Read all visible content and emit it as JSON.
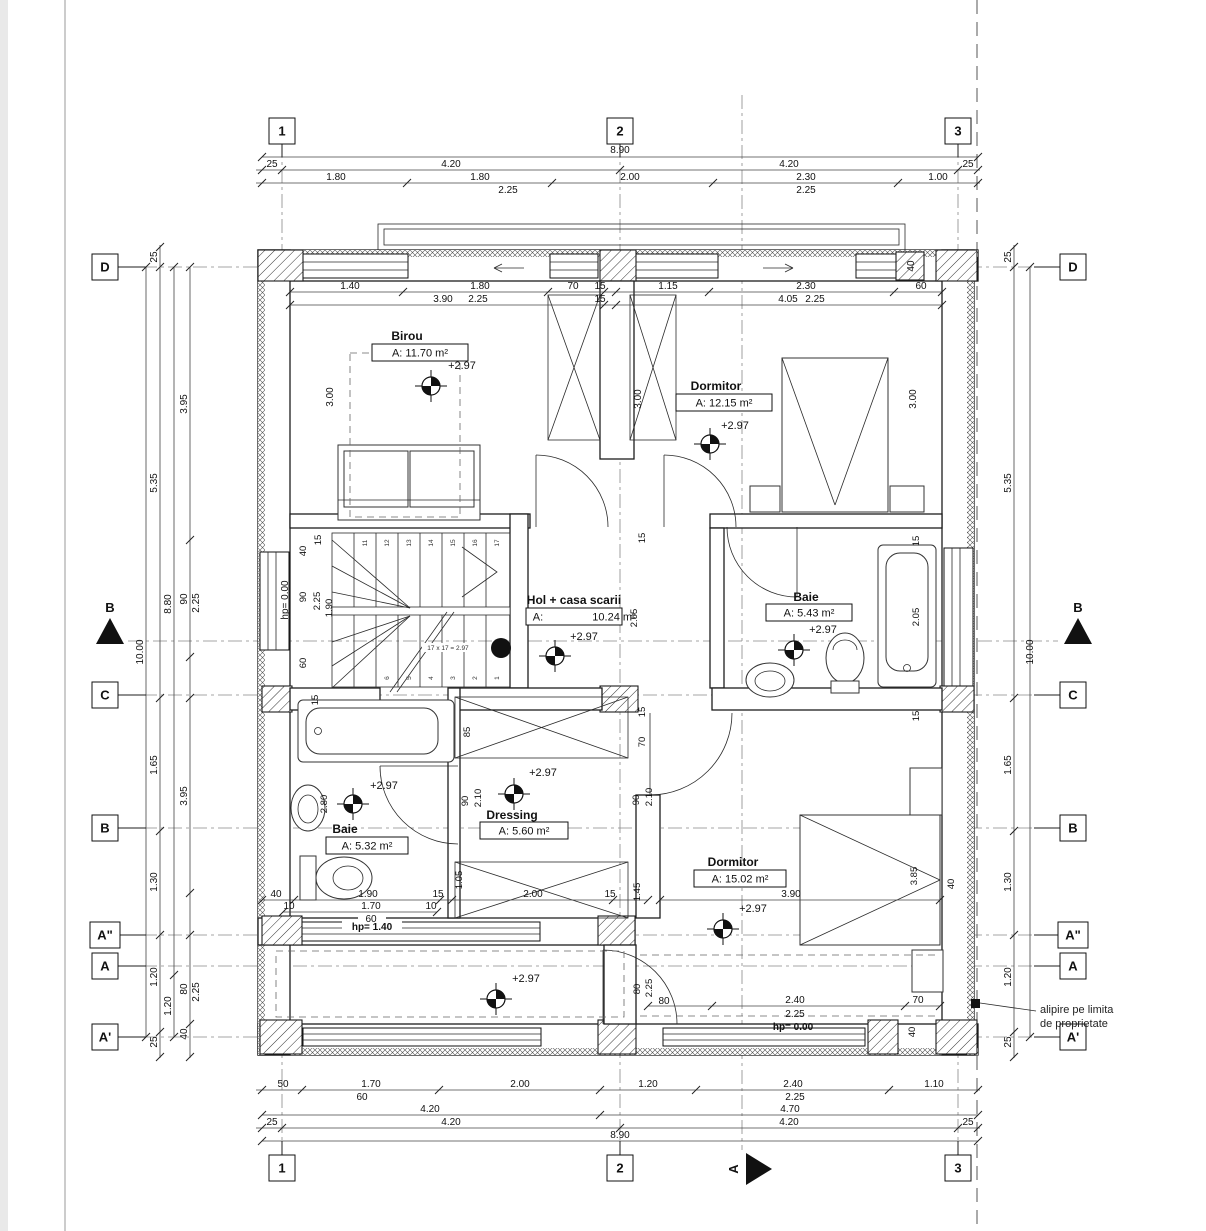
{
  "page": {
    "bg": "#ffffff",
    "edge": "#e9e9e9",
    "line": "#1d1d1d"
  },
  "grid": {
    "top": [
      "1",
      "2",
      "3"
    ],
    "bottom": [
      "1",
      "2",
      "3"
    ],
    "left": [
      "D",
      "C",
      "B",
      "A\"",
      "A",
      "A'"
    ],
    "right": [
      "D",
      "C",
      "B",
      "A\"",
      "A",
      "A'"
    ]
  },
  "sections": {
    "b": "B",
    "a": "A"
  },
  "note": {
    "l1": "alipire pe limita",
    "l2": "de proprietate"
  },
  "rooms": {
    "birou": {
      "name": "Birou",
      "area": "A: 11.70 m²",
      "level": "+2.97"
    },
    "dormitor1": {
      "name": "Dormitor",
      "area": "A: 12.15 m²",
      "level": "+2.97"
    },
    "hol": {
      "name": "Hol + casa scarii",
      "a": "A:",
      "v": "10.24 m²",
      "level": "+2.97"
    },
    "baie1": {
      "name": "Baie",
      "area": "A: 5.43 m²",
      "level": "+2.97"
    },
    "baie2": {
      "name": "Baie",
      "area": "A: 5.32 m²",
      "level": "+2.97"
    },
    "dressing": {
      "name": "Dressing",
      "area": "A: 5.60 m²",
      "level": "+2.97"
    },
    "dormitor2": {
      "name": "Dormitor",
      "area": "A: 15.02 m²",
      "level": "+2.97"
    },
    "balcon": {
      "level": "+2.97"
    }
  },
  "stair": {
    "formula": "17 x 17 = 2.97",
    "top": [
      "11",
      "12",
      "13",
      "14",
      "15",
      "16",
      "17"
    ],
    "bottom": [
      "6",
      "5",
      "4",
      "3",
      "2",
      "1"
    ]
  },
  "hp": {
    "left": "hp= 0.00",
    "mid": "hp= 1.40",
    "bottom": "hp= 0.00"
  },
  "dims": {
    "top1": [
      "8.90"
    ],
    "top2": [
      "25",
      "4.20",
      "4.20",
      "25"
    ],
    "top3": [
      "1.80",
      "1.80",
      "2.00",
      "2.30",
      "1.00"
    ],
    "top4": [
      "2.25",
      "2.25"
    ],
    "wt1": [
      "1.40",
      "1.80",
      "70",
      "15",
      "1.15",
      "2.30",
      "60"
    ],
    "wt2": [
      "3.90",
      "2.25",
      "15",
      "4.05",
      "2.25"
    ],
    "wt40": "40",
    "b1": [
      "50",
      "1.70",
      "2.00",
      "1.20",
      "2.40",
      "1.10"
    ],
    "b2": [
      "60",
      "2.25"
    ],
    "b3": [
      "4.20",
      "4.70"
    ],
    "b4": [
      "25",
      "4.20",
      "4.20",
      "25"
    ],
    "b5": [
      "8.90"
    ],
    "lt": "10.00",
    "l1": [
      "25",
      "5.35",
      "1.65",
      "1.30",
      "1.20",
      "25"
    ],
    "l2": [
      "8.80",
      "1.20"
    ],
    "l3": [
      "3.95",
      "90",
      "2.25",
      "3.95",
      "80",
      "2.25",
      "40"
    ],
    "r1": [
      "25",
      "5.35",
      "1.65",
      "1.30",
      "1.20",
      "25"
    ],
    "rt": "10.00",
    "v300": [
      "3.00",
      "3.00",
      "3.00"
    ],
    "sc": [
      "40",
      "15",
      "90",
      "2.25",
      "1.90",
      "60"
    ],
    "mc": [
      "15",
      "2.05",
      "15",
      "70"
    ],
    "ri": [
      "15",
      "2.05",
      "15"
    ],
    "d1": [
      "90",
      "2.10"
    ],
    "d2": [
      "90",
      "2.10"
    ],
    "b280": "2.80",
    "b15": "15",
    "d85": "85",
    "lb1": [
      "40",
      "1.90",
      "15",
      "2.00",
      "15"
    ],
    "lb2": [
      "10",
      "1.70",
      "10"
    ],
    "lb3": "60",
    "lbv": [
      "1.05",
      "1.45"
    ],
    "dm2": [
      "3.90",
      "3.85",
      "40"
    ],
    "br1": [
      "2.40",
      "2.25",
      "70"
    ],
    "br2": [
      "80",
      "2.25",
      "80",
      "40"
    ]
  }
}
